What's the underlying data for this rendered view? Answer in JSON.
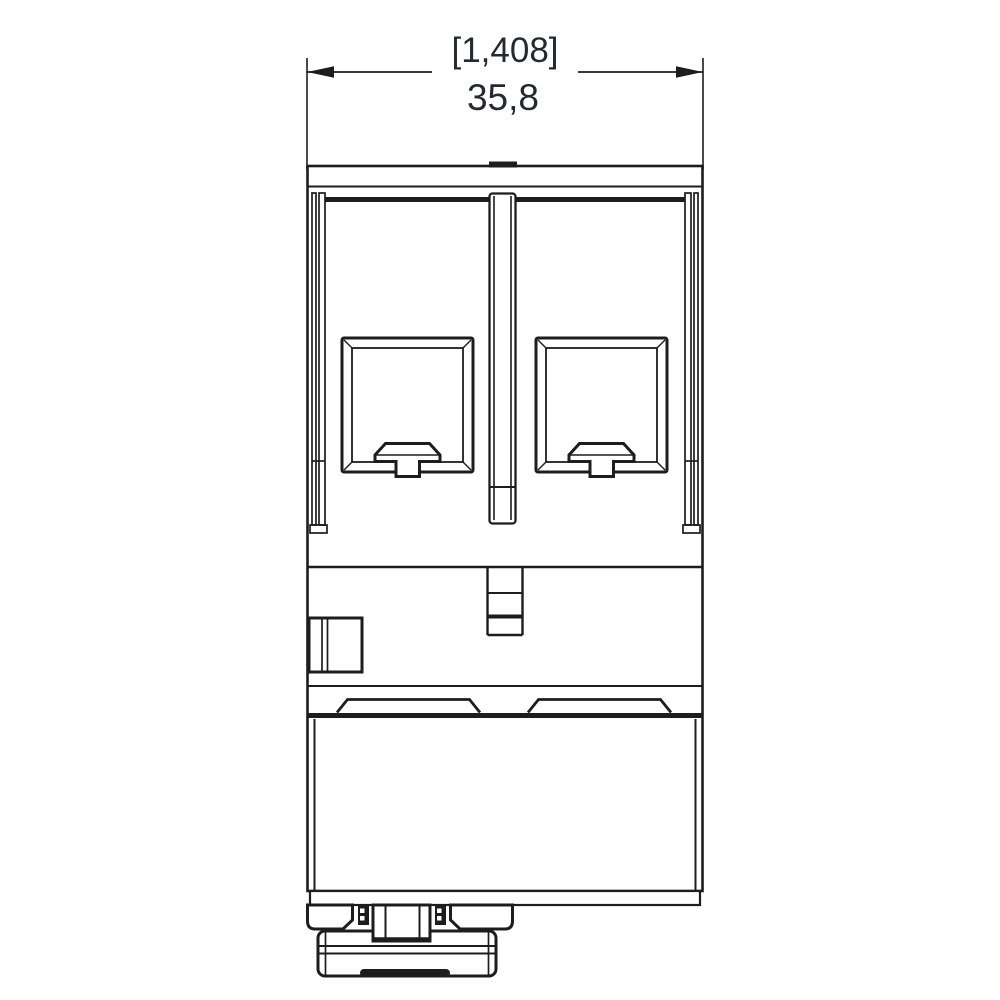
{
  "page": {
    "title": "Device side view technical drawing"
  },
  "dimension": {
    "reference_label": "[1,408]",
    "metric_label": "35,8",
    "extent_left_x": 307,
    "extent_right_x": 703
  },
  "colors": {
    "line": "#1d1d1f",
    "dimension_text": "#262932",
    "background": "#ffffff"
  }
}
